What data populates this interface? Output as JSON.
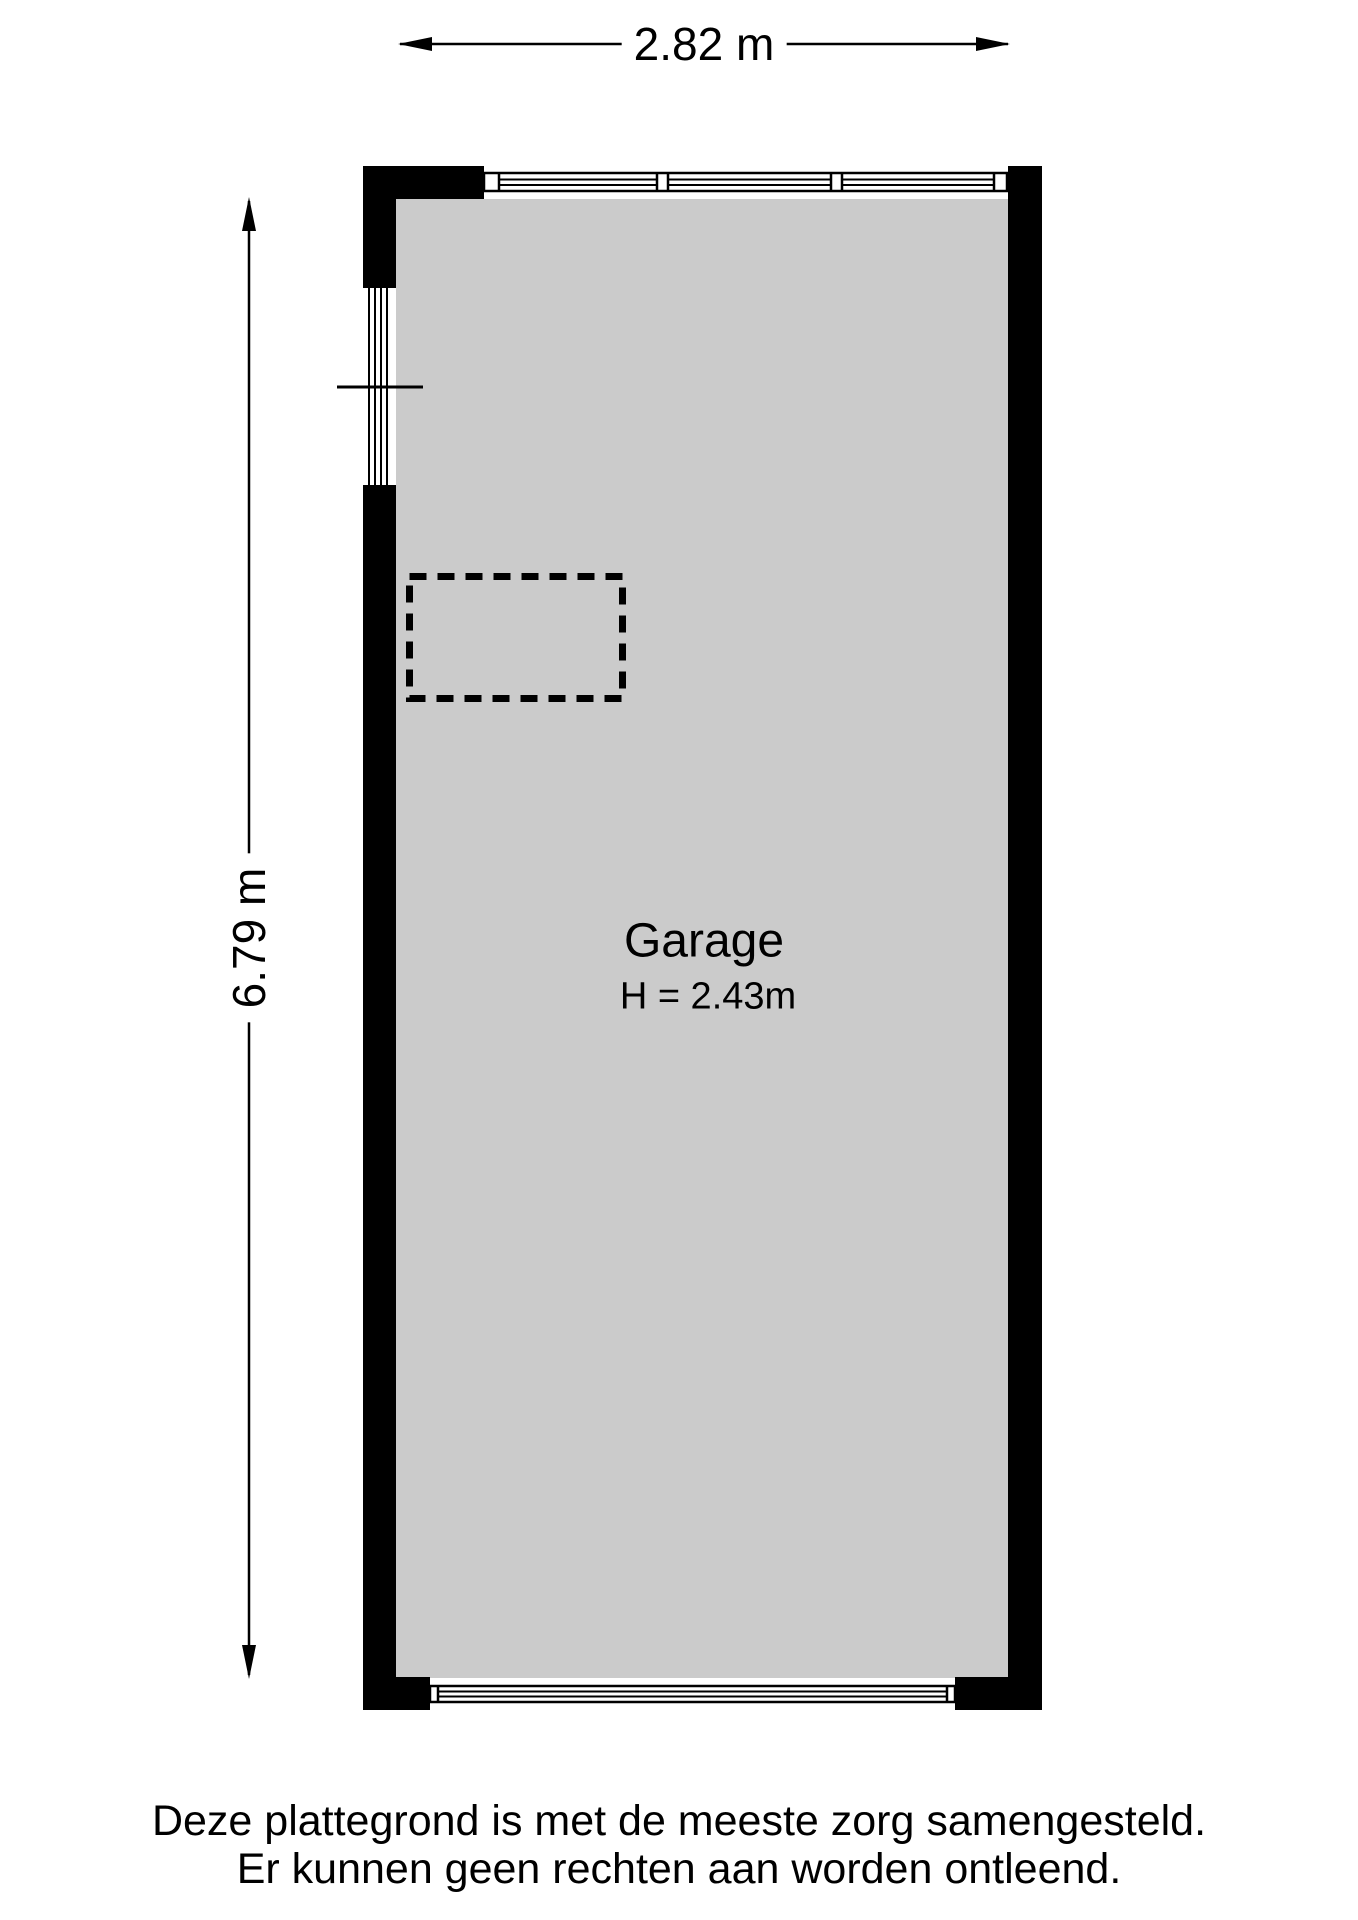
{
  "floorplan": {
    "room": {
      "name": "Garage",
      "ceiling_height": "H = 2.43m"
    },
    "dimensions": {
      "width": "2.82 m",
      "height": "6.79 m"
    },
    "disclaimer": {
      "line1": "Deze plattegrond is met de meeste zorg samengesteld.",
      "line2": "Er kunnen geen rechten aan worden ontleend."
    },
    "colors": {
      "wall": "#000000",
      "floor": "#cbcbcb",
      "background": "#ffffff",
      "line": "#000000"
    }
  }
}
